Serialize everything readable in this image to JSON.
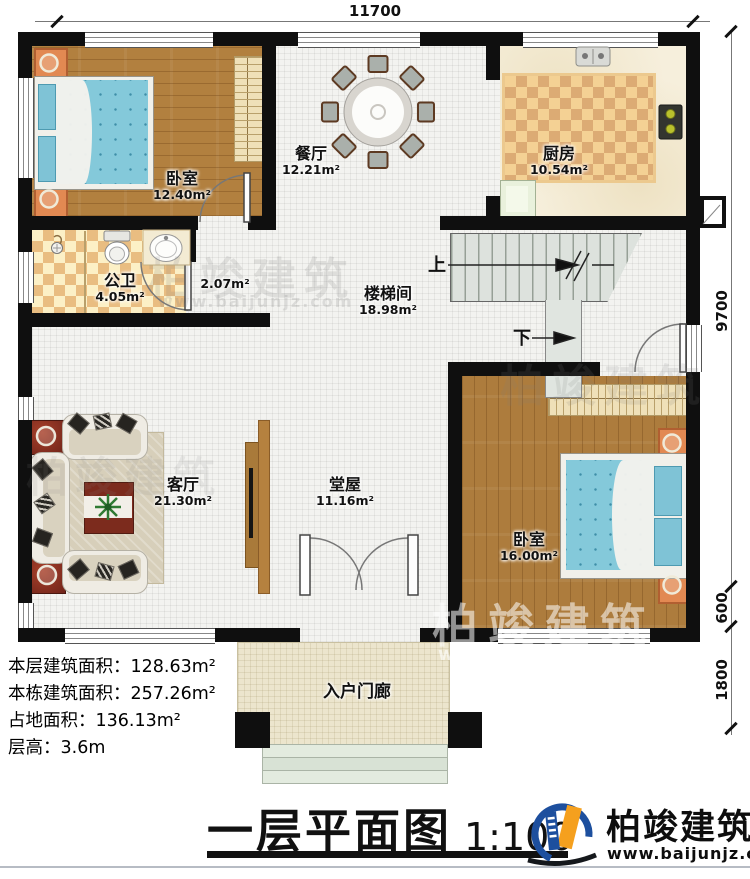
{
  "dimensions": {
    "top": "11700",
    "right_main": "9700",
    "right_mid": "600",
    "right_bottom": "1800"
  },
  "rooms": {
    "bedroom1": {
      "name": "卧室",
      "area": "12.40m²"
    },
    "dining": {
      "name": "餐厅",
      "area": "12.21m²"
    },
    "kitchen": {
      "name": "厨房",
      "area": "10.54m²"
    },
    "bathroom": {
      "name": "公卫",
      "area": "4.05m²"
    },
    "hallway": {
      "area": "2.07m²"
    },
    "stairwell": {
      "name": "楼梯间",
      "area": "18.98m²"
    },
    "living": {
      "name": "客厅",
      "area": "21.30m²"
    },
    "main_hall": {
      "name": "堂屋",
      "area": "11.16m²"
    },
    "bedroom2": {
      "name": "卧室",
      "area": "16.00m²"
    },
    "porch": {
      "name": "入户门廊"
    }
  },
  "stairs": {
    "up": "上",
    "down": "下"
  },
  "summary": {
    "line1": "本层建筑面积：128.63m²",
    "line2": "本栋建筑面积：257.26m²",
    "line3": "占地面积：136.13m²",
    "line4": "层高：3.6m"
  },
  "footer": {
    "title": "一层平面图",
    "scale": "1:100",
    "brand": "柏竣建筑",
    "website": "www.baijunjz.com"
  },
  "watermark": {
    "brand": "柏竣建筑",
    "website": "www.baijunjz.com"
  }
}
